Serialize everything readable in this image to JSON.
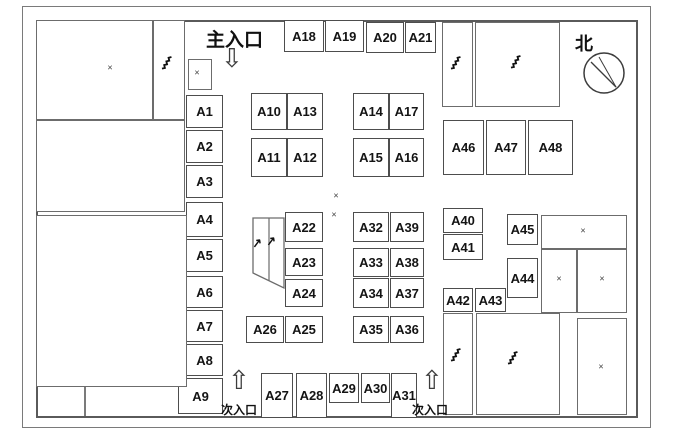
{
  "labels": {
    "main_entrance": "主入口",
    "sub_entrance_left": "次入口",
    "sub_entrance_right": "次入口",
    "north": "北"
  },
  "icons": {
    "down_arrow": "⇩",
    "up_arrow": "⇧",
    "x_mark": "×",
    "escalator": "↗"
  },
  "colors": {
    "background": "#ffffff",
    "wall": "#5a5a5a",
    "booth_border": "#4d4d4d",
    "text": "#141414"
  },
  "booths": [
    {
      "id": "A1",
      "x": 186,
      "y": 95,
      "w": 37,
      "h": 33
    },
    {
      "id": "A2",
      "x": 186,
      "y": 130,
      "w": 37,
      "h": 33
    },
    {
      "id": "A3",
      "x": 186,
      "y": 165,
      "w": 37,
      "h": 33
    },
    {
      "id": "A4",
      "x": 186,
      "y": 202,
      "w": 37,
      "h": 35
    },
    {
      "id": "A5",
      "x": 186,
      "y": 239,
      "w": 37,
      "h": 33
    },
    {
      "id": "A6",
      "x": 186,
      "y": 276,
      "w": 37,
      "h": 32
    },
    {
      "id": "A7",
      "x": 186,
      "y": 310,
      "w": 37,
      "h": 32
    },
    {
      "id": "A8",
      "x": 186,
      "y": 344,
      "w": 37,
      "h": 32
    },
    {
      "id": "A9",
      "x": 178,
      "y": 378,
      "w": 45,
      "h": 36
    },
    {
      "id": "A10",
      "x": 251,
      "y": 93,
      "w": 36,
      "h": 37
    },
    {
      "id": "A13",
      "x": 287,
      "y": 93,
      "w": 36,
      "h": 37
    },
    {
      "id": "A11",
      "x": 251,
      "y": 138,
      "w": 36,
      "h": 39
    },
    {
      "id": "A12",
      "x": 287,
      "y": 138,
      "w": 36,
      "h": 39
    },
    {
      "id": "A14",
      "x": 353,
      "y": 93,
      "w": 36,
      "h": 37
    },
    {
      "id": "A17",
      "x": 389,
      "y": 93,
      "w": 35,
      "h": 37
    },
    {
      "id": "A15",
      "x": 353,
      "y": 138,
      "w": 36,
      "h": 39
    },
    {
      "id": "A16",
      "x": 389,
      "y": 138,
      "w": 35,
      "h": 39
    },
    {
      "id": "A18",
      "x": 284,
      "y": 20,
      "w": 40,
      "h": 32
    },
    {
      "id": "A19",
      "x": 325,
      "y": 20,
      "w": 39,
      "h": 32
    },
    {
      "id": "A20",
      "x": 366,
      "y": 22,
      "w": 38,
      "h": 31
    },
    {
      "id": "A21",
      "x": 405,
      "y": 22,
      "w": 31,
      "h": 31
    },
    {
      "id": "A46",
      "x": 443,
      "y": 120,
      "w": 41,
      "h": 55
    },
    {
      "id": "A47",
      "x": 486,
      "y": 120,
      "w": 40,
      "h": 55
    },
    {
      "id": "A48",
      "x": 528,
      "y": 120,
      "w": 45,
      "h": 55
    },
    {
      "id": "A22",
      "x": 285,
      "y": 212,
      "w": 38,
      "h": 30
    },
    {
      "id": "A23",
      "x": 285,
      "y": 248,
      "w": 38,
      "h": 28
    },
    {
      "id": "A24",
      "x": 285,
      "y": 279,
      "w": 38,
      "h": 28
    },
    {
      "id": "A26",
      "x": 246,
      "y": 316,
      "w": 38,
      "h": 27
    },
    {
      "id": "A25",
      "x": 285,
      "y": 316,
      "w": 38,
      "h": 27
    },
    {
      "id": "A32",
      "x": 353,
      "y": 212,
      "w": 36,
      "h": 30
    },
    {
      "id": "A39",
      "x": 390,
      "y": 212,
      "w": 34,
      "h": 30
    },
    {
      "id": "A33",
      "x": 353,
      "y": 248,
      "w": 36,
      "h": 29
    },
    {
      "id": "A38",
      "x": 390,
      "y": 248,
      "w": 34,
      "h": 29
    },
    {
      "id": "A34",
      "x": 353,
      "y": 278,
      "w": 36,
      "h": 30
    },
    {
      "id": "A37",
      "x": 390,
      "y": 278,
      "w": 34,
      "h": 30
    },
    {
      "id": "A35",
      "x": 353,
      "y": 316,
      "w": 36,
      "h": 27
    },
    {
      "id": "A36",
      "x": 390,
      "y": 316,
      "w": 34,
      "h": 27
    },
    {
      "id": "A40",
      "x": 443,
      "y": 208,
      "w": 40,
      "h": 25
    },
    {
      "id": "A41",
      "x": 443,
      "y": 234,
      "w": 40,
      "h": 26
    },
    {
      "id": "A45",
      "x": 507,
      "y": 214,
      "w": 31,
      "h": 31
    },
    {
      "id": "A44",
      "x": 507,
      "y": 258,
      "w": 31,
      "h": 40
    },
    {
      "id": "A42",
      "x": 443,
      "y": 288,
      "w": 30,
      "h": 24
    },
    {
      "id": "A43",
      "x": 475,
      "y": 288,
      "w": 31,
      "h": 24
    },
    {
      "id": "A27",
      "x": 261,
      "y": 373,
      "w": 32,
      "h": 45
    },
    {
      "id": "A28",
      "x": 296,
      "y": 373,
      "w": 31,
      "h": 45
    },
    {
      "id": "A29",
      "x": 329,
      "y": 373,
      "w": 30,
      "h": 30
    },
    {
      "id": "A30",
      "x": 361,
      "y": 373,
      "w": 29,
      "h": 30
    },
    {
      "id": "A31",
      "x": 391,
      "y": 373,
      "w": 26,
      "h": 45
    }
  ],
  "rooms": [
    {
      "name": "room-top-left",
      "x": 36,
      "y": 20,
      "w": 117,
      "h": 100
    },
    {
      "name": "room-stair-top-left",
      "x": 153,
      "y": 20,
      "w": 32,
      "h": 100
    },
    {
      "name": "room-left-mid",
      "x": 36,
      "y": 120,
      "w": 149,
      "h": 92
    },
    {
      "name": "room-left-big",
      "x": 36,
      "y": 215,
      "w": 151,
      "h": 172
    },
    {
      "name": "room-x-small",
      "x": 188,
      "y": 59,
      "w": 24,
      "h": 31
    },
    {
      "name": "room-stair-top-1",
      "x": 442,
      "y": 22,
      "w": 31,
      "h": 85
    },
    {
      "name": "room-stair-top-2",
      "x": 475,
      "y": 22,
      "w": 85,
      "h": 85
    },
    {
      "name": "room-x-wide",
      "x": 541,
      "y": 215,
      "w": 86,
      "h": 34
    },
    {
      "name": "room-x-left",
      "x": 541,
      "y": 249,
      "w": 36,
      "h": 64
    },
    {
      "name": "room-x-right",
      "x": 577,
      "y": 249,
      "w": 50,
      "h": 64
    },
    {
      "name": "room-stair-bottom-1",
      "x": 443,
      "y": 313,
      "w": 30,
      "h": 102
    },
    {
      "name": "room-stair-bottom-2",
      "x": 476,
      "y": 313,
      "w": 84,
      "h": 102
    },
    {
      "name": "room-x-bottom-right",
      "x": 577,
      "y": 318,
      "w": 50,
      "h": 97
    }
  ],
  "marks": [
    {
      "type": "x",
      "x": 110,
      "y": 68
    },
    {
      "type": "x",
      "x": 197,
      "y": 73
    },
    {
      "type": "x",
      "x": 336,
      "y": 196
    },
    {
      "type": "x",
      "x": 334,
      "y": 215
    },
    {
      "type": "x",
      "x": 583,
      "y": 231
    },
    {
      "type": "x",
      "x": 559,
      "y": 279
    },
    {
      "type": "x",
      "x": 602,
      "y": 279
    },
    {
      "type": "x",
      "x": 601,
      "y": 367
    },
    {
      "type": "stairs",
      "x": 166,
      "y": 62
    },
    {
      "type": "stairs",
      "x": 455,
      "y": 62
    },
    {
      "type": "stairs",
      "x": 515,
      "y": 61
    },
    {
      "type": "stairs",
      "x": 455,
      "y": 354
    },
    {
      "type": "stairs",
      "x": 512,
      "y": 357
    },
    {
      "type": "esc",
      "x": 257,
      "y": 243
    },
    {
      "type": "esc",
      "x": 271,
      "y": 241
    }
  ]
}
